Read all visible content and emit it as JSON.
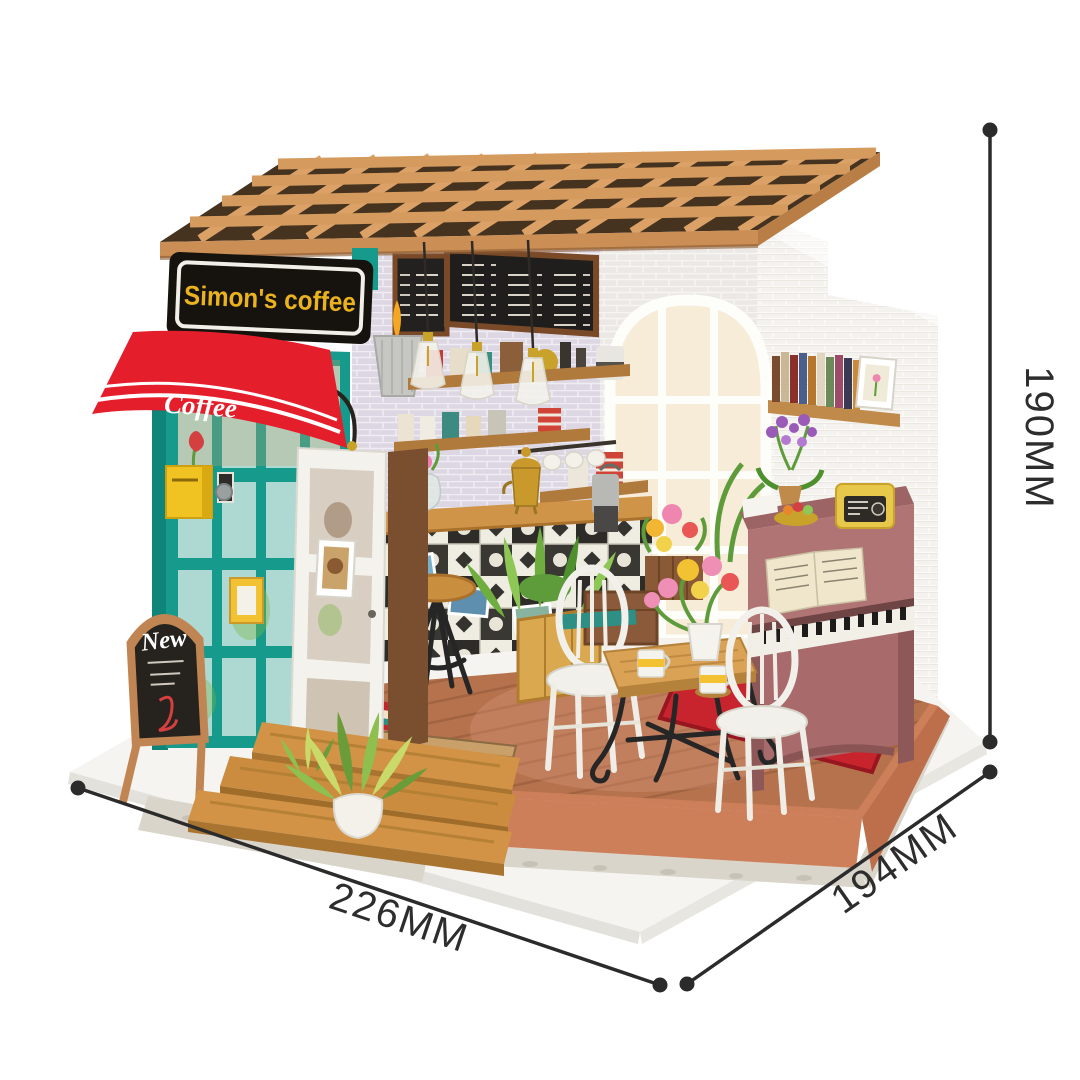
{
  "storefront": {
    "sign_text": "Simon's coffee",
    "awning_text": "Coffee",
    "sandwich_board_text": "New"
  },
  "dimension_labels": {
    "width": "226MM",
    "depth": "194MM",
    "height": "190MM"
  },
  "colors": {
    "background": "#ffffff",
    "awning_red": "#e41e2b",
    "storefront_teal": "#169a8c",
    "sign_yellow": "#eab31e",
    "sign_black": "#16130f",
    "roof_tan": "#dba167",
    "floor_terracotta": "#cd7f5a",
    "floor_wood": "#b5724d",
    "piano_mauve": "#b17474",
    "rug_red": "#c8242e",
    "brick_lavender": "#ddd7e3",
    "brick_white": "#f4f2ee",
    "dimension_line": "#2b2b2b"
  }
}
